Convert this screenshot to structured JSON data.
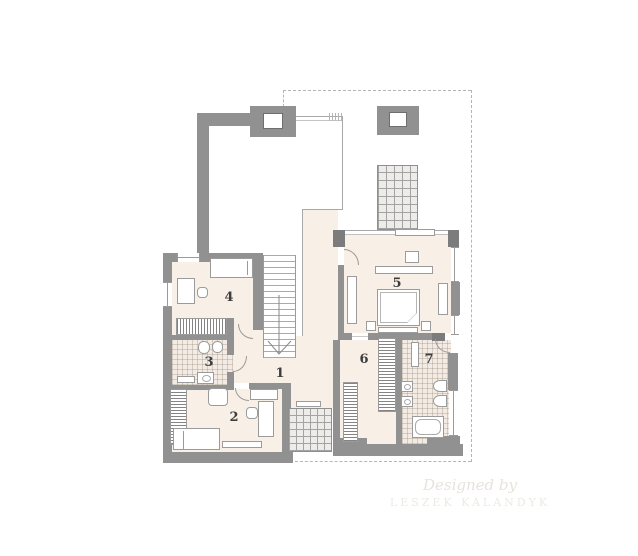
{
  "plan": {
    "type": "floor-plan",
    "level": "upper-floor"
  },
  "rooms": [
    {
      "label": "1"
    },
    {
      "label": "2"
    },
    {
      "label": "3"
    },
    {
      "label": "4"
    },
    {
      "label": "5"
    },
    {
      "label": "6"
    },
    {
      "label": "7"
    }
  ],
  "watermark": {
    "line1": "Designed by",
    "line2": "LESZEK KALANDYK"
  },
  "colors": {
    "wall": "#919191",
    "wall_dark": "#7c7c7c",
    "floor": "#f8f0e7",
    "tile": "#f4ece4",
    "dash": "#b5b5b5",
    "label": "#3d3d3d",
    "watermark": "#e7e3dc"
  }
}
